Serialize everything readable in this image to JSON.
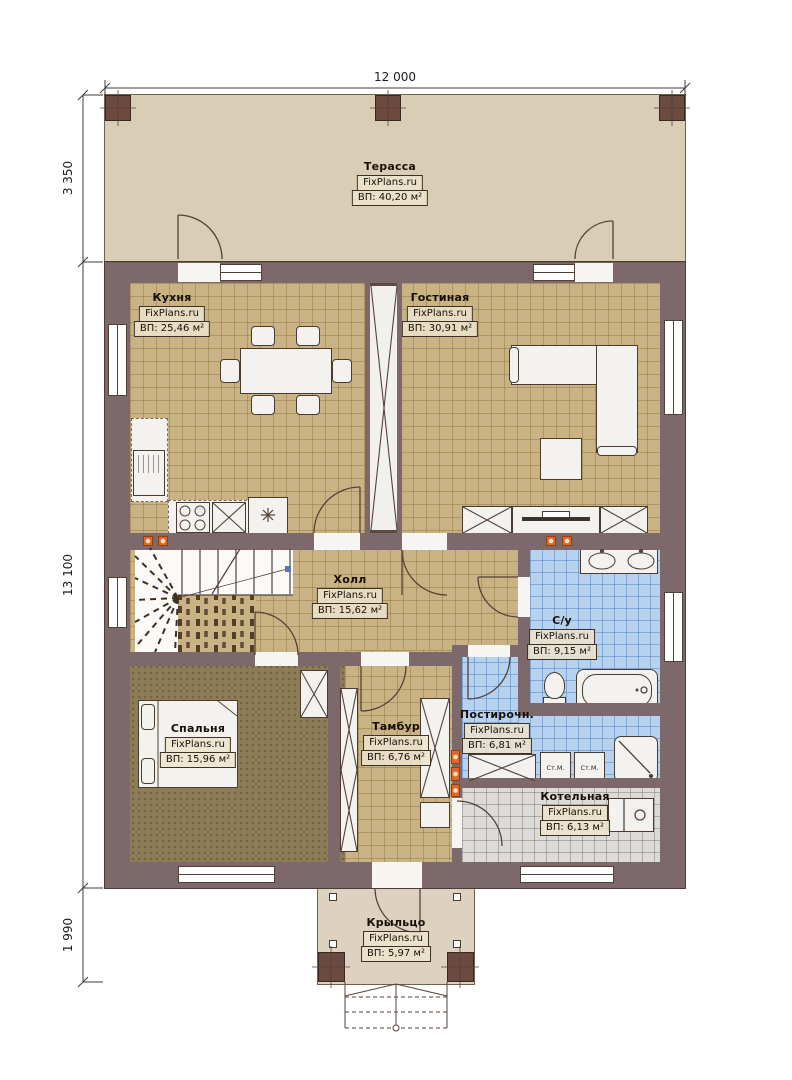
{
  "brand": "FixPlans.ru",
  "dimensions": {
    "width_top": "12 000",
    "terrace_depth": "3 350",
    "house_depth": "13 100",
    "porch_depth": "1 990"
  },
  "rooms": {
    "terrace": {
      "name": "Терасса",
      "area": "ВП: 40,20 м²"
    },
    "kitchen": {
      "name": "Кухня",
      "area": "ВП: 25,46 м²"
    },
    "living": {
      "name": "Гостиная",
      "area": "ВП: 30,91 м²"
    },
    "hall": {
      "name": "Холл",
      "area": "ВП: 15,62 м²"
    },
    "bathroom": {
      "name": "С/у",
      "area": "ВП: 9,15 м²"
    },
    "bedroom": {
      "name": "Спальня",
      "area": "ВП: 15,96 м²"
    },
    "vestibule": {
      "name": "Тамбур",
      "area": "ВП: 6,76 м²"
    },
    "laundry": {
      "name": "Постирочн.",
      "area": "ВП: 6,81 м²"
    },
    "boiler": {
      "name": "Котельная",
      "area": "ВП: 6,13 м²"
    },
    "porch": {
      "name": "Крыльцо",
      "area": "ВП: 5,97 м²"
    }
  },
  "appliances": {
    "washer_left": "Ст.М.",
    "washer_right": "Ст.М."
  },
  "colors": {
    "wall": "#7d686b",
    "floor_tile": "#c9b284",
    "floor_wet": "#b7d2ee",
    "floor_tech": "#dcdbd8",
    "floor_bedroom": "#8d7c58",
    "terrace": "#d9cdb5",
    "vent_accent": "#e0662c"
  }
}
